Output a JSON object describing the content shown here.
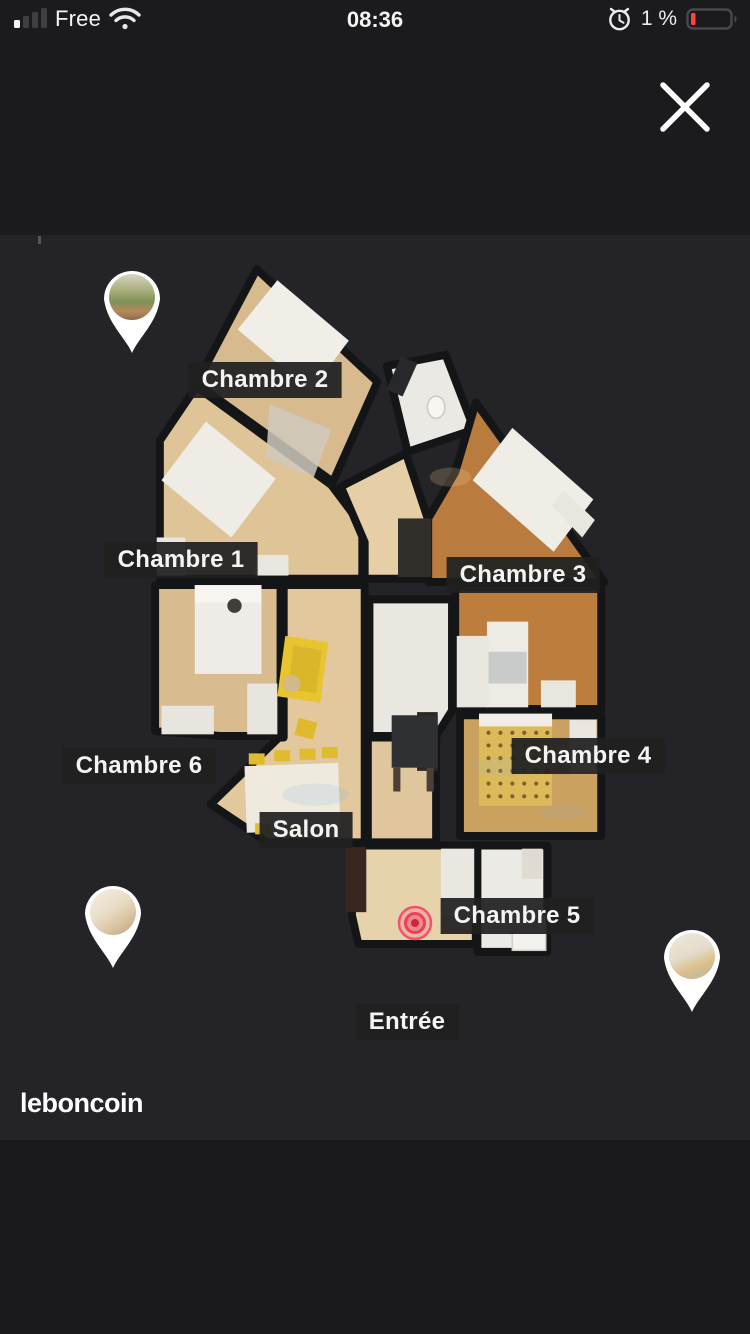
{
  "status_bar": {
    "carrier": "Free",
    "time": "08:36",
    "battery_percent": "1 %",
    "icons": {
      "signal": "cellular-signal-1-of-4",
      "wifi": "wifi-full",
      "alarm": "alarm-clock",
      "battery": "battery-low-red"
    }
  },
  "overlay": {
    "close_icon": "close-x"
  },
  "viewer": {
    "type": "3d-dollhouse-floorplan",
    "labels": [
      {
        "id": "chambre-2",
        "text": "Chambre 2"
      },
      {
        "id": "chambre-1",
        "text": "Chambre 1"
      },
      {
        "id": "chambre-3",
        "text": "Chambre 3"
      },
      {
        "id": "chambre-6",
        "text": "Chambre 6"
      },
      {
        "id": "chambre-4",
        "text": "Chambre 4"
      },
      {
        "id": "salon",
        "text": "Salon"
      },
      {
        "id": "chambre-5",
        "text": "Chambre 5"
      },
      {
        "id": "entree",
        "text": "Entrée"
      }
    ],
    "pins": [
      {
        "id": "pin-balcony",
        "photo": "balcony-greenery"
      },
      {
        "id": "pin-hallway",
        "photo": "beige-corner"
      },
      {
        "id": "pin-bedroom",
        "photo": "bedroom-doorway"
      }
    ],
    "marker": {
      "type": "current-position-bullseye",
      "color": "#f4436a"
    }
  },
  "branding": {
    "logo": "leboncoin"
  },
  "colors": {
    "label_bg": "#202021",
    "marker_pink": "#f4436a",
    "battery_low_red": "#ff453a",
    "viewer_bg": "#242428",
    "page_bg": "#1b1b1d"
  }
}
